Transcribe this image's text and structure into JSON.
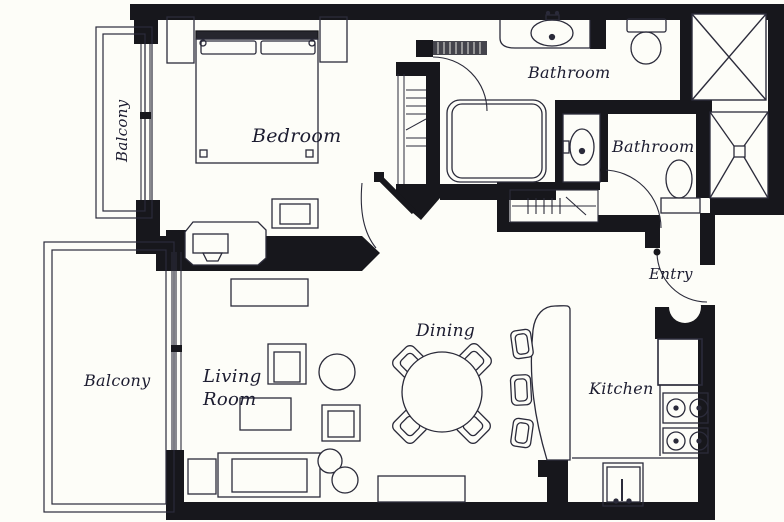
{
  "title": "Apartment Floor Plan",
  "colors": {
    "wall": "#17171c",
    "line": "#2b2b3a",
    "paper": "#fdfdf8",
    "text": "#1c1c30"
  },
  "rooms": {
    "balcony_upper": {
      "label": "Balcony"
    },
    "bedroom": {
      "label": "Bedroom"
    },
    "bathroom_main": {
      "label": "Bathroom"
    },
    "bathroom_second": {
      "label": "Bathroom"
    },
    "entry": {
      "label": "Entry"
    },
    "balcony_lower": {
      "label": "Balcony"
    },
    "living_room": {
      "label": "Living Room"
    },
    "dining": {
      "label": "Dining"
    },
    "kitchen": {
      "label": "Kitchen"
    }
  },
  "fixtures": {
    "bed": "double-bed",
    "nightstands": "two-nightstands",
    "wardrobe": "shelved-closet",
    "desk": "desk-with-computer",
    "bathtub": "bathtub",
    "sinks": "two-vanity-sinks",
    "toilets": "two-toilets",
    "showers": "two-shower-stalls",
    "dining_set": "round-table-four-chairs",
    "bar": "breakfast-bar-three-stools",
    "kitchen": "fridge-stove-sink",
    "sofa_set": "sofa-armchairs-tables"
  }
}
